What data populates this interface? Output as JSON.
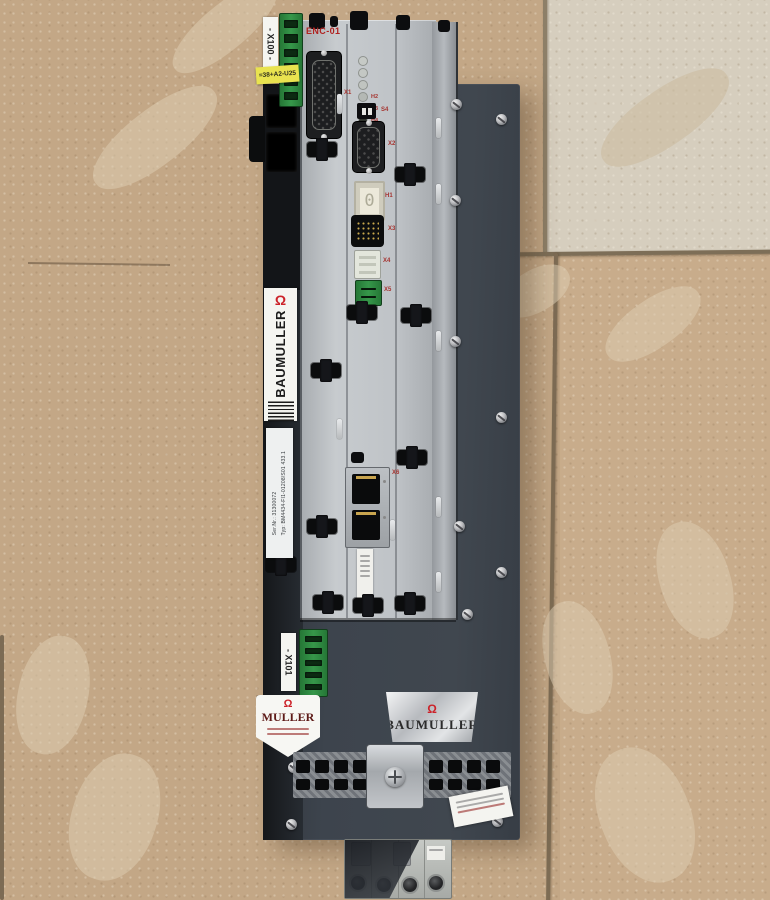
{
  "photo": {
    "subject": "Baumüller BM4434 servo drive / encoder module lying on a concrete floor"
  },
  "device": {
    "x100_label": "- X100 -",
    "location_tag": "=38+A2-U25",
    "enc_label": "ENC-01",
    "brand_vertical": "BAUMULLER",
    "brand_logo_glyph": "Ω",
    "type_plate": {
      "typ_key": "Typ:",
      "typ_value": "BM4434-FI1-01208/S01 433.1",
      "ser_key": "Ser.Nr.:",
      "ser_value": "31300072"
    },
    "x101_label": "- X101",
    "shield_left_brand": "MULLER",
    "shield_right_brand": "BAUMULLER",
    "display_value": "0",
    "port_labels": {
      "db15": "X1",
      "db9": "X2",
      "dip_switch": "S4",
      "status_display": "H1",
      "pin_socket": "X3",
      "aux_connector": "X4",
      "green_terminal": "X5",
      "ethernet": "X6"
    },
    "led_labels": [
      "H2",
      "H3",
      "H4"
    ]
  },
  "colors": {
    "floor_tan": "#c3a786",
    "floor_light_tile": "#d6cebe",
    "chassis_dark": "#3d444d",
    "module_silver": "#bfc3c7",
    "brand_red": "#cc2229",
    "label_yellow": "#e9e34f",
    "terminal_green": "#36974a"
  }
}
